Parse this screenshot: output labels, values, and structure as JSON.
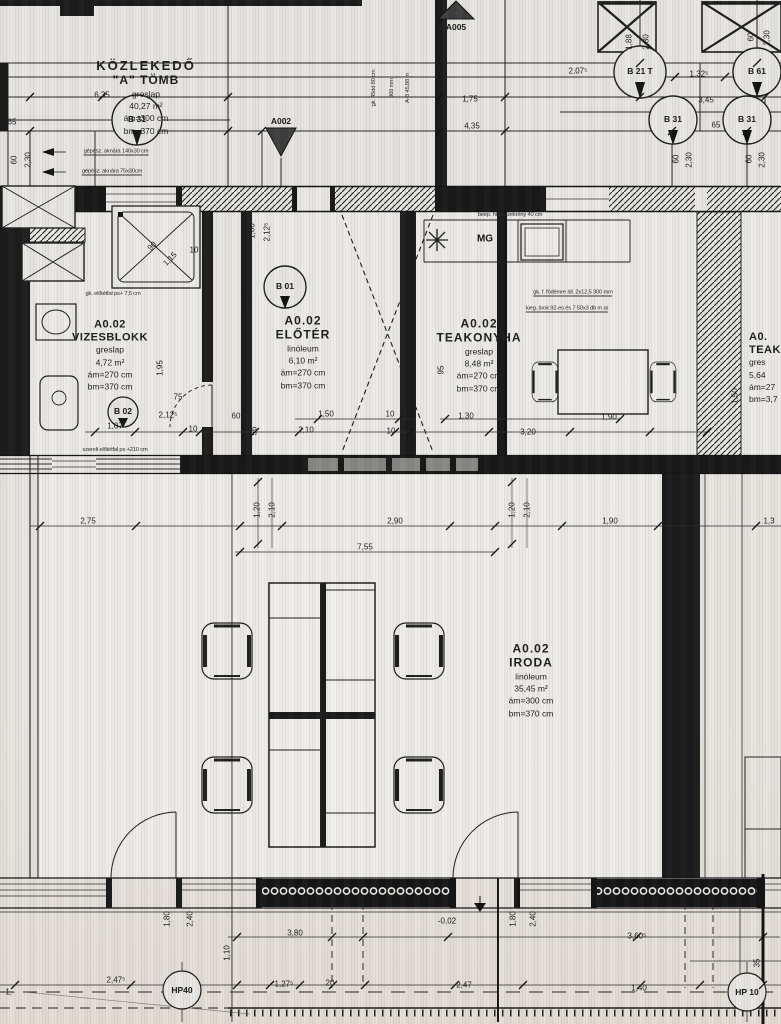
{
  "rooms": {
    "kozlekedo": {
      "name": "KÖZLEKEDŐ",
      "block": "\"A\" TÖMB",
      "floor": "greslap",
      "area": "40,27 m²",
      "am": "ám=300 cm",
      "bm": "bm=370 cm"
    },
    "vizesblokk": {
      "code": "A0.02",
      "name": "VIZESBLOKK",
      "floor": "greslap",
      "area": "4,72 m²",
      "am": "ám=270 cm",
      "bm": "bm=370 cm"
    },
    "eloter": {
      "code": "A0.02",
      "name": "ELŐTÉR",
      "floor": "linóleum",
      "area": "6,10 m²",
      "am": "ám=270 cm",
      "bm": "bm=370 cm"
    },
    "teakonyha": {
      "code": "A0.02",
      "name": "TEAKONYHA",
      "floor": "greslap",
      "area": "8,48 m²",
      "am": "ám=270 cm",
      "bm": "bm=370 cm"
    },
    "iroda": {
      "code": "A0.02",
      "name": "IRODA",
      "floor": "linóleum",
      "area": "35,45 m²",
      "am": "ám=300 cm",
      "bm": "bm=370 cm"
    },
    "teakonyha_right": {
      "code": "A0.",
      "name": "TEAKO",
      "floor": "gres",
      "area": "5,64",
      "am": "ám=27",
      "bm": "bm=3,7"
    }
  },
  "markers": [
    {
      "t": "A005",
      "x": 456,
      "y": 27
    },
    {
      "t": "A002",
      "x": 281,
      "y": 121
    },
    {
      "t": "B 01",
      "x": 285,
      "y": 286
    },
    {
      "t": "B 02",
      "x": 123,
      "y": 411
    },
    {
      "t": "B 31",
      "x": 137,
      "y": 119
    },
    {
      "t": "B 21 T",
      "x": 640,
      "y": 71
    },
    {
      "t": "B 61",
      "x": 757,
      "y": 71
    },
    {
      "t": "B 31",
      "x": 673,
      "y": 119
    },
    {
      "t": "B 31",
      "x": 747,
      "y": 119
    },
    {
      "t": "HP40",
      "x": 182,
      "y": 990
    },
    {
      "t": "HP 10",
      "x": 747,
      "y": 992
    },
    {
      "t": "MG",
      "x": 485,
      "y": 239,
      "mg": 1
    }
  ],
  "dimensions": [
    {
      "t": "6,35",
      "x": 102,
      "y": 95
    },
    {
      "t": "2,07⁵",
      "x": 578,
      "y": 71
    },
    {
      "t": "1,32⁵",
      "x": 699,
      "y": 74
    },
    {
      "t": "3,45",
      "x": 706,
      "y": 100
    },
    {
      "t": "65",
      "x": 716,
      "y": 125
    },
    {
      "t": "1,88",
      "x": 629,
      "y": 42,
      "r": -90
    },
    {
      "t": "2,30",
      "x": 646,
      "y": 42,
      "r": -90
    },
    {
      "t": "60",
      "x": 751,
      "y": 37,
      "r": -90
    },
    {
      "t": "2,30",
      "x": 767,
      "y": 38,
      "r": -90
    },
    {
      "t": "60",
      "x": 676,
      "y": 159,
      "r": -90
    },
    {
      "t": "2,30",
      "x": 689,
      "y": 160,
      "r": -90
    },
    {
      "t": "60",
      "x": 749,
      "y": 159,
      "r": -90
    },
    {
      "t": "2,30",
      "x": 762,
      "y": 160,
      "r": -90
    },
    {
      "t": "60",
      "x": 14,
      "y": 160,
      "r": -90
    },
    {
      "t": "2,30",
      "x": 28,
      "y": 160,
      "r": -90
    },
    {
      "t": "65",
      "x": 12,
      "y": 122
    },
    {
      "t": "1,75",
      "x": 470,
      "y": 99
    },
    {
      "t": "4,35",
      "x": 472,
      "y": 126
    },
    {
      "t": "1,95",
      "x": 160,
      "y": 368,
      "r": -90
    },
    {
      "t": "75",
      "x": 178,
      "y": 397
    },
    {
      "t": "2,12⁵",
      "x": 168,
      "y": 415
    },
    {
      "t": "1,07",
      "x": 115,
      "y": 426
    },
    {
      "t": "10",
      "x": 193,
      "y": 429
    },
    {
      "t": "2,85",
      "x": 208,
      "y": 310,
      "r": -90
    },
    {
      "t": "90",
      "x": 152,
      "y": 246,
      "r": -45
    },
    {
      "t": "1,15",
      "x": 170,
      "y": 259,
      "r": -45
    },
    {
      "t": "10",
      "x": 194,
      "y": 250
    },
    {
      "t": "1,00",
      "x": 252,
      "y": 231,
      "r": -90
    },
    {
      "t": "2,12⁵",
      "x": 267,
      "y": 232,
      "r": -90
    },
    {
      "t": "2,27⁵",
      "x": 248,
      "y": 296,
      "r": -90
    },
    {
      "t": "1,50",
      "x": 326,
      "y": 414
    },
    {
      "t": "10",
      "x": 390,
      "y": 414
    },
    {
      "t": "2,10",
      "x": 306,
      "y": 430
    },
    {
      "t": "10",
      "x": 391,
      "y": 431
    },
    {
      "t": "60",
      "x": 236,
      "y": 416
    },
    {
      "t": "56",
      "x": 254,
      "y": 431,
      "r": -90
    },
    {
      "t": "1,0",
      "x": 228,
      "y": 468,
      "r": -90
    },
    {
      "t": "95",
      "x": 441,
      "y": 370,
      "r": -90
    },
    {
      "t": "1,30",
      "x": 466,
      "y": 416
    },
    {
      "t": "3,20",
      "x": 528,
      "y": 432
    },
    {
      "t": "1,90",
      "x": 609,
      "y": 417
    },
    {
      "t": "1,50",
      "x": 735,
      "y": 396,
      "r": -90
    },
    {
      "t": "2,75",
      "x": 88,
      "y": 521
    },
    {
      "t": "1,20",
      "x": 257,
      "y": 510,
      "r": -90
    },
    {
      "t": "2,10",
      "x": 272,
      "y": 510,
      "r": -90
    },
    {
      "t": "2,90",
      "x": 395,
      "y": 521
    },
    {
      "t": "1,20",
      "x": 512,
      "y": 510,
      "r": -90
    },
    {
      "t": "2,10",
      "x": 527,
      "y": 510,
      "r": -90
    },
    {
      "t": "1,90",
      "x": 610,
      "y": 521
    },
    {
      "t": "1,3",
      "x": 769,
      "y": 521
    },
    {
      "t": "7,55",
      "x": 365,
      "y": 547
    },
    {
      "t": "1,80",
      "x": 167,
      "y": 919,
      "r": -90
    },
    {
      "t": "2,40",
      "x": 190,
      "y": 919,
      "r": -90
    },
    {
      "t": "1,80",
      "x": 513,
      "y": 919,
      "r": -90
    },
    {
      "t": "2,40",
      "x": 533,
      "y": 919,
      "r": -90
    },
    {
      "t": "1,10",
      "x": 227,
      "y": 953,
      "r": -90
    },
    {
      "t": "3,80",
      "x": 295,
      "y": 933
    },
    {
      "t": "-0,02",
      "x": 447,
      "y": 921
    },
    {
      "t": "3,60⁵",
      "x": 637,
      "y": 936
    },
    {
      "t": "2,47⁵",
      "x": 116,
      "y": 980
    },
    {
      "t": "1,27⁵",
      "x": 284,
      "y": 984
    },
    {
      "t": "20",
      "x": 330,
      "y": 983
    },
    {
      "t": "2,47",
      "x": 464,
      "y": 985
    },
    {
      "t": "1,40",
      "x": 639,
      "y": 988
    },
    {
      "t": "35",
      "x": 757,
      "y": 963,
      "r": -90
    },
    {
      "t": "1,-",
      "x": 10,
      "y": 992
    }
  ],
  "annotations": [
    {
      "t": "gépész. aknára 140x30 cm",
      "x": 116,
      "y": 152,
      "u": 1
    },
    {
      "t": "gépész. aknára 75x30cm",
      "x": 112,
      "y": 172,
      "u": 1
    },
    {
      "t": "gk. előtétfal ps+ 7,5 cm",
      "x": 113,
      "y": 294
    },
    {
      "t": "szerelt előtétfal ps +210 cm",
      "x": 115,
      "y": 450
    },
    {
      "t": "gk. f. födémre áll. 2x12,5 300 mm",
      "x": 573,
      "y": 293,
      "u": 1
    },
    {
      "t": "kieg. árok 92-es és 7 50x3 db m ar",
      "x": 567,
      "y": 309,
      "u": 1
    },
    {
      "t": "beép. hűtő szekrény 40 cm",
      "x": 510,
      "y": 215
    },
    {
      "t": "gk. 45dd 80 cm",
      "x": 374,
      "y": 88,
      "r": -90
    },
    {
      "t": "968 mm",
      "x": 392,
      "y": 88,
      "r": -90
    },
    {
      "t": "A-B 45,88 m",
      "x": 408,
      "y": 88,
      "r": -90
    }
  ]
}
